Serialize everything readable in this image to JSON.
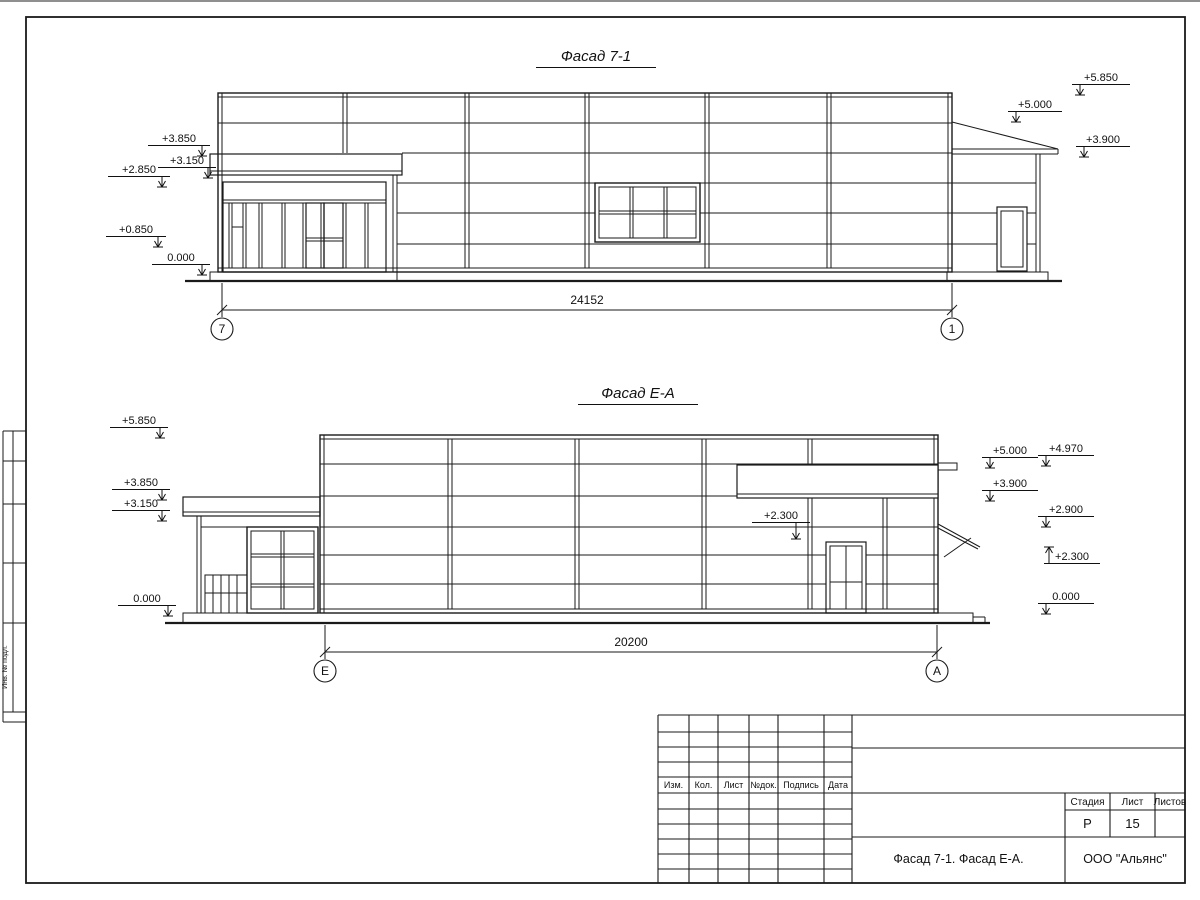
{
  "page": {
    "side_stamp": {
      "label": "Инв. № подл."
    },
    "titleblock": {
      "rev_headers": [
        "Изм.",
        "Кол.",
        "Лист",
        "№док.",
        "Подпись",
        "Дата"
      ],
      "stage_label": "Стадия",
      "sheet_label": "Лист",
      "sheets_label": "Листов",
      "stage_value": "Р",
      "sheet_value": "15",
      "sheets_value": "",
      "doc_title": "Фасад 7-1. Фасад Е-А.",
      "company": "ООО \"Альянс\""
    }
  },
  "facade1": {
    "title": "Фасад 7-1",
    "dim": "24152",
    "axis_left": "7",
    "axis_right": "1",
    "marks": [
      {
        "label": "+3.850",
        "x": 148,
        "y": 145,
        "w": 62,
        "a": "rd"
      },
      {
        "label": "+3.150",
        "x": 158,
        "y": 167,
        "w": 58,
        "a": "rd"
      },
      {
        "label": "+2.850",
        "x": 108,
        "y": 176,
        "w": 62,
        "a": "rd"
      },
      {
        "label": "+0.850",
        "x": 106,
        "y": 236,
        "w": 60,
        "a": "rd"
      },
      {
        "label": "0.000",
        "x": 152,
        "y": 264,
        "w": 58,
        "a": "rd"
      },
      {
        "label": "+5.850",
        "x": 1072,
        "y": 84,
        "w": 58,
        "a": "ld"
      },
      {
        "label": "+5.000",
        "x": 1008,
        "y": 111,
        "w": 54,
        "a": "ld"
      },
      {
        "label": "+3.900",
        "x": 1076,
        "y": 146,
        "w": 54,
        "a": "ld"
      }
    ]
  },
  "facade2": {
    "title": "Фасад Е-А",
    "dim": "20200",
    "axis_left": "Е",
    "axis_right": "А",
    "marks": [
      {
        "label": "+5.850",
        "x": 110,
        "y": 427,
        "w": 58,
        "a": "rd"
      },
      {
        "label": "+3.850",
        "x": 112,
        "y": 489,
        "w": 58,
        "a": "rd"
      },
      {
        "label": "+3.150",
        "x": 112,
        "y": 510,
        "w": 58,
        "a": "rd"
      },
      {
        "label": "0.000",
        "x": 118,
        "y": 605,
        "w": 58,
        "a": "rd"
      },
      {
        "label": "+2.300",
        "x": 752,
        "y": 522,
        "w": 58,
        "a": "leader"
      },
      {
        "label": "+5.000",
        "x": 982,
        "y": 457,
        "w": 56,
        "a": "ld"
      },
      {
        "label": "+3.900",
        "x": 982,
        "y": 490,
        "w": 56,
        "a": "ld"
      },
      {
        "label": "+4.970",
        "x": 1038,
        "y": 455,
        "w": 56,
        "a": "ld"
      },
      {
        "label": "+2.900",
        "x": 1038,
        "y": 516,
        "w": 56,
        "a": "ld"
      },
      {
        "label": "+2.300",
        "x": 1044,
        "y": 563,
        "w": 56,
        "a": "lu"
      },
      {
        "label": "0.000",
        "x": 1038,
        "y": 603,
        "w": 56,
        "a": "ld"
      }
    ]
  }
}
